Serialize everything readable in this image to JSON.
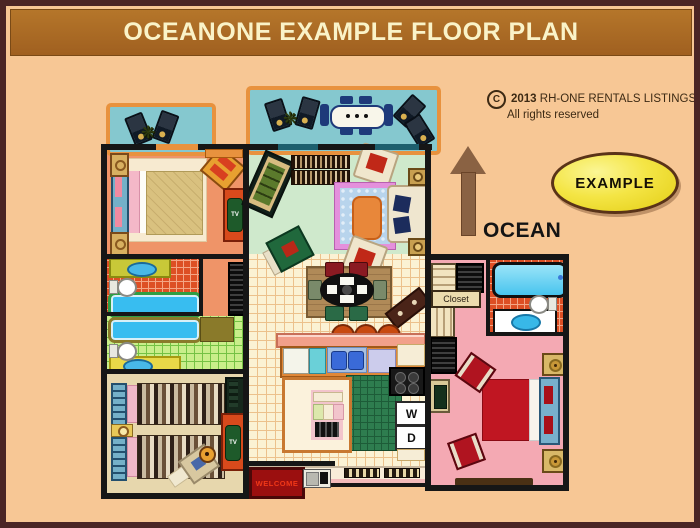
{
  "header": {
    "title": "OCEANONE EXAMPLE FLOOR PLAN"
  },
  "copyright": {
    "symbol": "C",
    "year": "2013",
    "owner": "RH-ONE RENTALS LISTINGS",
    "rights": "All rights reserved"
  },
  "annotations": {
    "badge": "EXAMPLE",
    "direction": "OCEAN"
  },
  "plan_labels": {
    "closet": "Closet",
    "washer": "W",
    "dryer": "D",
    "welcome_mat": "WELCOME",
    "tv": "TV"
  },
  "icons": {
    "plant": "❋"
  },
  "colors": {
    "background": "#f7c795",
    "header_bar": "#aa6a22",
    "header_text": "#faf3c8",
    "outer_frame": "#4b2525",
    "balcony_floor": "#85c8cf",
    "balcony_rail": "#e8923e",
    "bedroom1_floor": "#ef9468",
    "bedroom2_floor": "#e7d7ad",
    "living_floor": "#cfe9cc",
    "kitchen_tile": "#fbf2d4",
    "master_floor": "#f4a9b3",
    "bath_tile_red": "#dd4f24",
    "bath_tile_green": "#c9ee8a",
    "tub_water": "#38bdf0",
    "badge_fill": "#f4e545",
    "arrow_brown": "#8a6243",
    "welcome_mat": "#9b0f0f",
    "master_bed": "#c01622"
  }
}
